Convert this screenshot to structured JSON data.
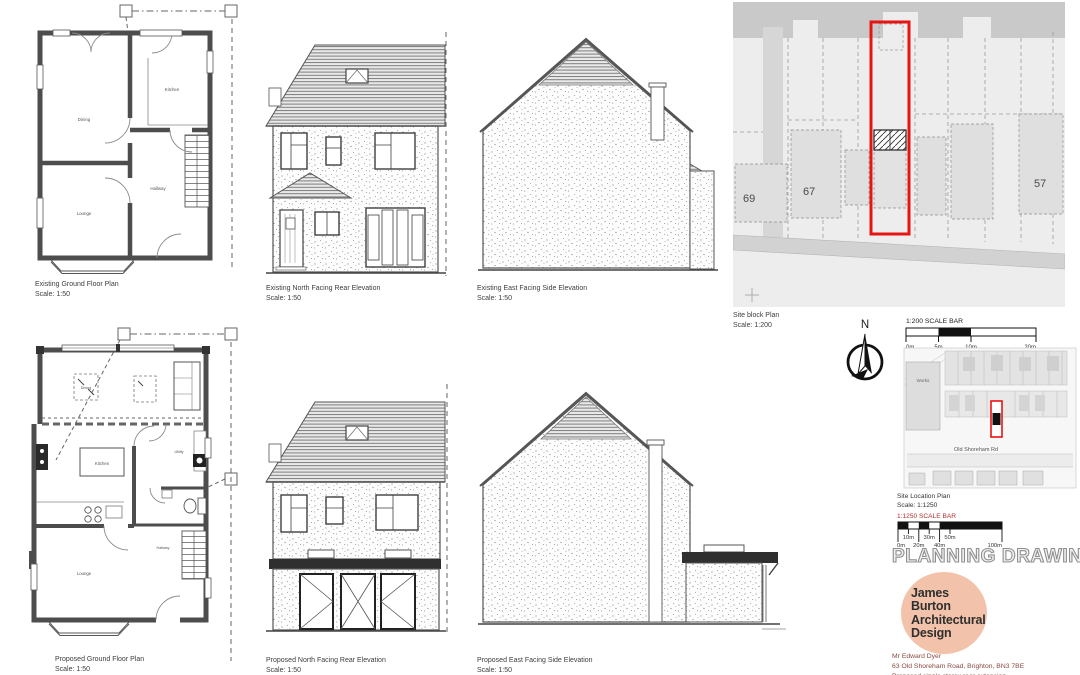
{
  "drawings": {
    "existing_plan": {
      "title": "Existing Ground Floor Plan",
      "scale": "Scale: 1:50",
      "rooms": {
        "dining": "Dining",
        "kitchen": "Kitchen",
        "lounge": "Lounge",
        "hallway": "Hallway"
      }
    },
    "existing_rear": {
      "title": "Existing North Facing Rear Elevation",
      "scale": "Scale: 1:50"
    },
    "existing_side": {
      "title": "Existing East Facing Side Elevation",
      "scale": "Scale: 1:50"
    },
    "proposed_plan": {
      "title": "Proposed Ground Floor Plan",
      "scale": "Scale: 1:50",
      "rooms": {
        "dining": "Dining",
        "kitchen": "Kitchen",
        "utility": "Utility",
        "lounge": "Lounge",
        "hallway": "Hallway"
      }
    },
    "proposed_rear": {
      "title": "Proposed North Facing Rear Elevation",
      "scale": "Scale: 1:50"
    },
    "proposed_side": {
      "title": "Proposed East Facing Side Elevation",
      "scale": "Scale: 1:50"
    }
  },
  "site_block_plan": {
    "title": "Site block Plan",
    "scale": "Scale: 1:200",
    "house_numbers": [
      "69",
      "67",
      "57"
    ]
  },
  "compass": {
    "north_label": "N"
  },
  "scale_bar_200": {
    "title": "1:200 SCALE BAR",
    "ticks": [
      "0m",
      "5m",
      "10m",
      "20m"
    ]
  },
  "site_location_plan": {
    "title": "Site Location Plan",
    "scale": "Scale: 1:1250",
    "road_label": "Old Shoreham Rd",
    "works_label": "Works"
  },
  "scale_bar_1250": {
    "title": "1:1250 SCALE BAR",
    "ticks_upper": [
      "10m",
      "30m",
      "50m"
    ],
    "ticks_lower": [
      "0m",
      "20m",
      "40m",
      "100m"
    ]
  },
  "stamp": {
    "text": "PLANNING DRAWING"
  },
  "logo": {
    "line1": "James Burton",
    "line2": "Architectural",
    "line3": "Design"
  },
  "project": {
    "client": "Mr Edward Dyer",
    "address": "63 Old Shoreham Road, Brighton, BN3 7BE",
    "description": "Proposed single storey rear extension"
  },
  "colors": {
    "plot_outline_red": "#e81313",
    "scale_bar_1250_title": "#b03030",
    "logo_circle": "#f2c3aa",
    "wall_gray": "#4d4d4d",
    "fascia_dark": "#2f2f2f"
  }
}
